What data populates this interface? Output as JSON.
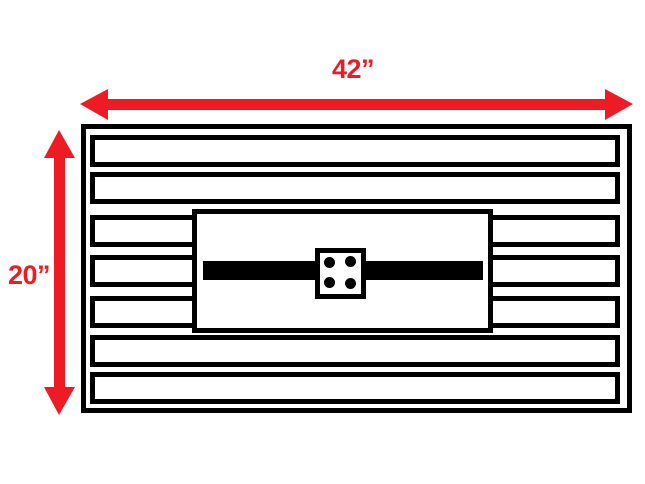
{
  "diagram": {
    "width_label": "42”",
    "height_label": "20”",
    "colors": {
      "dimension_red": "#ED1C24",
      "line_black": "#000000",
      "background": "#FFFFFF"
    },
    "components": {
      "slat_count": 7,
      "split_slat_rows": "3,4,5",
      "bolt_hole_count": 4
    }
  }
}
